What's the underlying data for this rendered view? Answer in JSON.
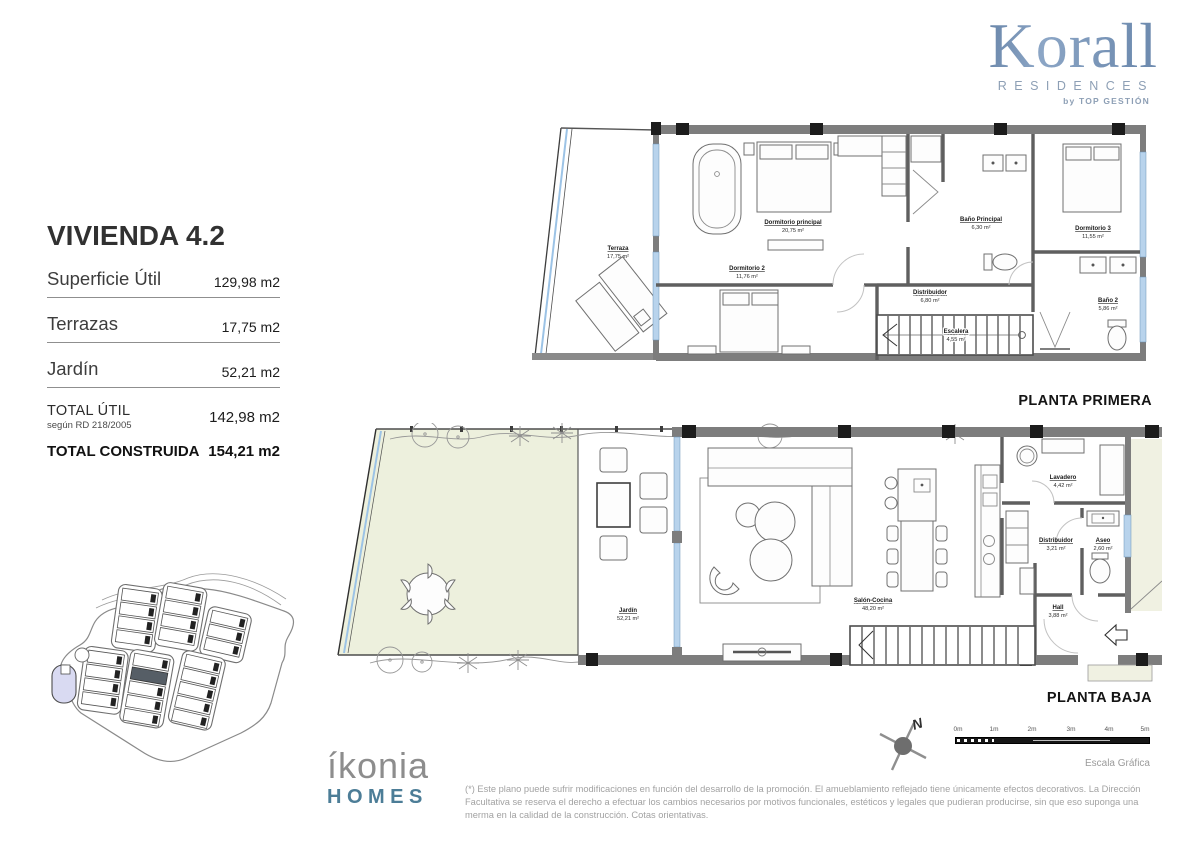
{
  "brand": {
    "korall": "Korall",
    "residences": "RESIDENCES",
    "by": "by TOP GESTIÓN"
  },
  "unit": {
    "title": "VIVIENDA 4.2",
    "rows": [
      {
        "label": "Superficie Útil",
        "value": "129,98 m2"
      },
      {
        "label": "Terrazas",
        "value": "17,75 m2"
      },
      {
        "label": "Jardín",
        "value": "52,21 m2"
      }
    ],
    "total_util": {
      "label": "TOTAL ÚTIL",
      "sublabel": "según RD 218/2005",
      "value": "142,98 m2"
    },
    "total_construida": {
      "label": "TOTAL CONSTRUIDA",
      "value": "154,21 m2"
    }
  },
  "floor1": {
    "caption": "PLANTA PRIMERA",
    "rooms": {
      "terraza": {
        "name": "Terraza",
        "area": "17,75 m²"
      },
      "dormitorio_principal": {
        "name": "Dormitorio principal",
        "area": "20,75 m²"
      },
      "dormitorio2": {
        "name": "Dormitorio 2",
        "area": "11,76 m²"
      },
      "bano_principal": {
        "name": "Baño Principal",
        "area": "6,30 m²"
      },
      "dormitorio3": {
        "name": "Dormitorio 3",
        "area": "11,55 m²"
      },
      "bano2": {
        "name": "Baño 2",
        "area": "5,86 m²"
      },
      "distribuidor": {
        "name": "Distribuidor",
        "area": "6,80 m²"
      },
      "escalera": {
        "name": "Escalera",
        "area": "4,55 m²"
      }
    }
  },
  "floor0": {
    "caption": "PLANTA BAJA",
    "rooms": {
      "jardin": {
        "name": "Jardín",
        "area": "52,21 m²"
      },
      "salon_cocina": {
        "name": "Salón-Cocina",
        "area": "48,20 m²"
      },
      "lavadero": {
        "name": "Lavadero",
        "area": "4,42 m²"
      },
      "distribuidor": {
        "name": "Distribuidor",
        "area": "3,21 m²"
      },
      "aseo": {
        "name": "Aseo",
        "area": "2,60 m²"
      },
      "hall": {
        "name": "Hall",
        "area": "3,88 m²"
      }
    }
  },
  "footer": {
    "ikonia": "íkonia",
    "homes": "HOMES",
    "disclaimer": "(*) Este plano puede sufrir modificaciones en función del desarrollo de la promoción. El amueblamiento reflejado tiene únicamente efectos decorativos. La Dirección Facultativa se reserva el derecho a efectuar los cambios necesarios por motivos funcionales, estéticos y legales que pudieran producirse, sin que eso suponga una merma en la calidad de la construcción. Cotas orientativas.",
    "scale": {
      "ticks": [
        "0m",
        "1m",
        "2m",
        "3m",
        "4m",
        "5m"
      ],
      "label": "Escala Gráfica"
    },
    "north": "N"
  },
  "colors": {
    "brand_blue": "#4f6f96",
    "homes_blue": "#4c7d97",
    "garden_green": "#edf0dd",
    "window_blue": "#b8d3ec",
    "wall_gray": "#7d7d7d"
  }
}
